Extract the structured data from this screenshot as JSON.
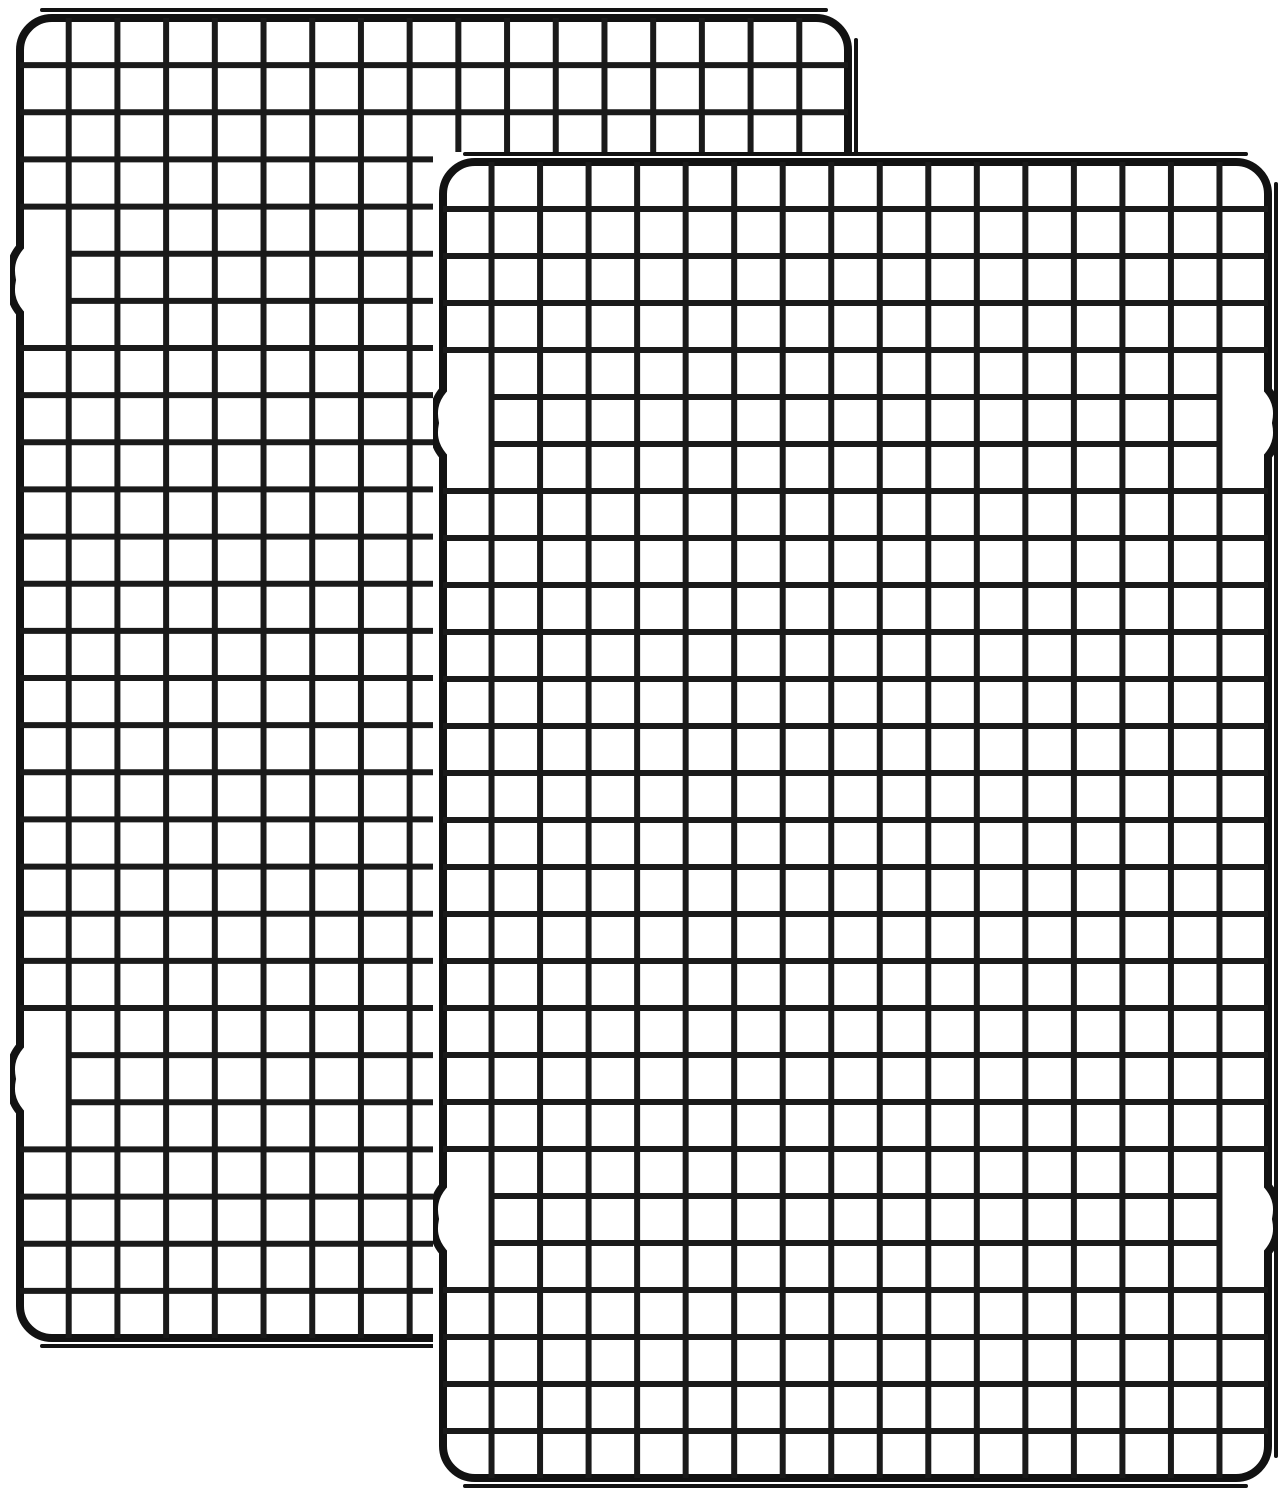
{
  "scene": {
    "background": "#ffffff",
    "wire_color": "#1a1a1a",
    "frame_color": "#121212",
    "description": "Two overlapping black steel wire cooling racks on a white background"
  },
  "racks": [
    {
      "label": "back cooling rack",
      "x": 10,
      "y": 8,
      "width": 848,
      "height": 1340,
      "columns": 17,
      "rows": 28,
      "corner_radius": 32,
      "frame_inset": 10,
      "frame_stroke": 8,
      "wire_stroke": 6,
      "edge_wire_stroke": 4,
      "opaque": false,
      "notch_centers_rel": [
        0.203,
        0.799
      ],
      "notch_half_height": 33,
      "notch_depth": 10,
      "notch_row_tolerance": 31
    },
    {
      "label": "front cooling rack",
      "x": 433,
      "y": 152,
      "width": 845,
      "height": 1336,
      "columns": 17,
      "rows": 28,
      "corner_radius": 32,
      "frame_inset": 10,
      "frame_stroke": 8,
      "wire_stroke": 6,
      "edge_wire_stroke": 4,
      "opaque": true,
      "notch_centers_rel": [
        0.203,
        0.799
      ],
      "notch_half_height": 33,
      "notch_depth": 10,
      "notch_row_tolerance": 31
    }
  ]
}
